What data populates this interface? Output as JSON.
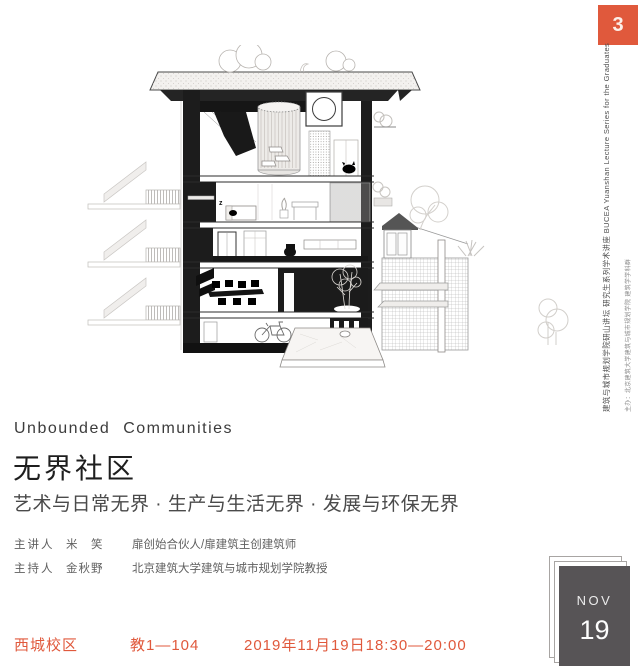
{
  "poster": {
    "badge_number": "3",
    "accent_orange": "#e0593c",
    "card_gray": "#575456"
  },
  "side_text": {
    "main": "建筑与城市规划学院研山讲坛 研究生系列学术讲座 BUCEA Yuanshan Lecture Series for the Graduates",
    "sub": "主办：北京建筑大学建筑与城市规划学院 建筑学学科群"
  },
  "titles": {
    "english": "Unbounded Communities",
    "chinese": "无界社区",
    "subtitle": "艺术与日常无界 · 生产与生活无界 · 发展与环保无界"
  },
  "people": [
    {
      "role": "主讲人",
      "name": "米　笑",
      "desc": "扉创始合伙人/扉建筑主创建筑师"
    },
    {
      "role": "主持人",
      "name": "金秋野",
      "desc": "北京建筑大学建筑与城市规划学院教授"
    }
  ],
  "footer": {
    "campus": "西城校区",
    "room": "教1—104",
    "datetime": "2019年11月19日18:30—20:00"
  },
  "date_card": {
    "month": "NOV",
    "day": "19"
  },
  "illustration": {
    "label": "building-section-drawing"
  }
}
